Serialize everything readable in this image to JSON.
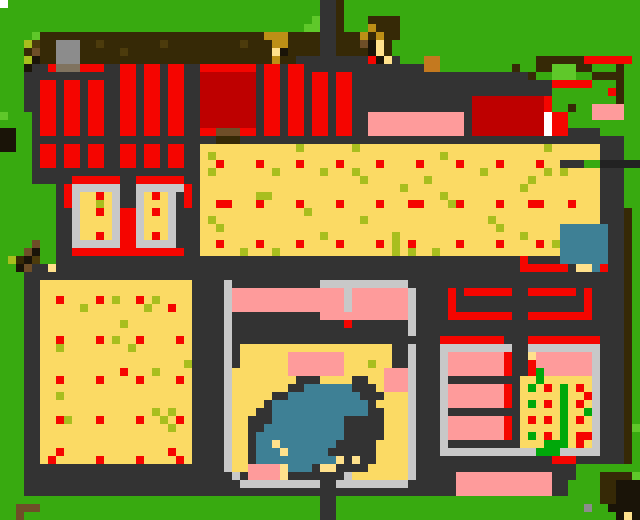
{
  "map": {
    "width_px": 640,
    "height_px": 520,
    "cell_size": 8,
    "cols": 80,
    "rows": 65,
    "palette": {
      "G": "#38AA10",
      "L": "#5FC82A",
      "N": "#00A80A",
      "D": "#333333",
      "C": "#C8C8C8",
      "E": "#8C8C8C",
      "m": "#80735F",
      "R": "#F50500",
      "r": "#BE0000",
      "P": "#FE9B9B",
      "Y": "#FBDA64",
      "F": "#FFE18C",
      "y": "#A8BE1E",
      "B": "#362906",
      "o": "#4C3B0C",
      "b": "#6E4E28",
      "O": "#C4791F",
      "U": "#BC8F16",
      "K": "#1A1408",
      "T": "#3E8095",
      "W": "#FFFFFF"
    },
    "legend": {
      "G": "grass",
      "L": "light-grass",
      "N": "crop-green",
      "D": "dark-path",
      "C": "light-stone",
      "E": "gray-block",
      "m": "stone-shadow",
      "R": "red-roof",
      "r": "dark-red-roof",
      "P": "pink-roof",
      "Y": "field-yellow",
      "F": "pale-sand",
      "y": "olive-sprout",
      "B": "dark-soil",
      "o": "soil-speck",
      "b": "wood-brown",
      "O": "orange-crate",
      "U": "gold",
      "K": "black-soil",
      "T": "pond-water",
      "W": "white"
    },
    "rows_rle": [
      "W1G39D2B1G37",
      "G40D2B1G37",
      "G39L1D2B1G3B4G30",
      "G38L2D2B1G3U1B3G30",
      "G4L1B28U3B4D2B3U1B1U1B2G30",
      "G3y1o1B2E3B2o1B7o1B9o1B3U2B4D2B3b1K1F1B1G31",
      "G3B1b1B2E3B5o1B18F1K1B4D2B4K1F1B1G31",
      "G3y1K1B2E3B24U1B2D9R1K1F1D1G3O2G12B6R6G1",
      "G3K1D2R1m3R3D2R2D1R2D1R2D2R7D1R2D1R2D15O2G9B1G2B2L3B2G3B1G2",
      "G3D12R2D1R2D1R2D2r7D1R2D1R2D1R2D1R2D22B1G2L3G2B4G2",
      "G3D2R2D1R2D1R2D2R2D1R2D1R2D2r7D1R2D1R2D1R2D1R2D25R5G3B1G2",
      "G3D2R2D1R2D1R2D2R2D1R2D1R2D2r7D1R2D1R2D1R2D1R2D25G7R1B1G2",
      "G3D2R2D1R2D1R2D2R2D1R2D1R2D2r7D1R2D1R2D1R2D1R2D15r9R1G8B1G2",
      "G3D2R2D1R2D1R2D2R2D1R2D1R2D2r7D1R2D1R2D1R2D1R2D15r9R1G2B1G2P4G2",
      "L1G3D1R2D1R2D1R2D2R2D1R2D1R2D2r7D1R2D1R2D1R2D1R2D2P12D1r9W1R2G3P4G2",
      "G4D1R2D1R2D1R2D2R2D1R2D1R2D2r7D1R2D1R2D1R2D1R2D2P12D1r9W1R2G9",
      "K2G2D1R2D1R2D1R2D2R2D1R2D1R2D2R2b3R2D1R2D1R2D1R2D1R2D2P12D1r9W1R2D4G5",
      "K2G2D23B3D48G2",
      "K2G2D1R2D1R2D1R2D2R2D1R2D1R2D2Y12y1Y6y1Y23y1Y6D3G2",
      "G4D1R2D1R2D1R2D2R2D1R2D1R2D2Y1y1Y28y1Y19D3G2",
      "G4D1R2D1R2D1R2D2R2D1R2D1R2D2Y2R1Y4R1Y4R1Y4R1Y4R1Y4R1Y4R1Y4R1Y4R1Y2D3G2",
      "G4D21Y1y1Y7y1Y5y1Y3y1Y15y1Y7y1Y1y1Y4D3G2",
      "G4D5R6D2R6D2Y20y1Y7y1Y12y1Y8D3G2",
      "G7D1R1C6D2C6R1D1Y25y1Y14y1Y9D3G2",
      "G7D1R1C1Y2R1Y1C1D2C1Y1R1Y1C1D1R1D1Y7y2Y21y1Y19D3G2",
      "G7D1R1C1Y2y1Y1C1D2C1Y3C1D1R1D1Y2R2Y3R1Y4R1Y4R1Y4R1Y3R2Y3y1R1Y4R1Y3R2Y3R1Y3D3G2",
      "G7D2C1Y2R1Y1C1R2C1Y1R1Y1C1D3Y13y1Y36D3B1G1",
      "G7D2C1Y4C1R2C1Y3C1D3Y1y1Y18y1Y15y1Y13D3B1G1",
      "G7D2C1Y4C1R2C1Y3C1D3Y2y1Y34y1Y7T6D2B1G1",
      "G7D2C1Y2R1Y1C1R2C1Y1R1Y1C1D3Y15y1Y8y1Y15y1Y4T6D2B1G1",
      "G4b1G2D2C6R2C5D3Y2R1Y4R1Y4R1Y4R1Y4R1Y1y1Y1R1Y5R1Y4R1Y4R1Y1y1T6D2B1G1",
      "G3b1K1G2D2R14D2Y5y1Y3y1Y14y1Y1y1Y2y1Y15T6D2B1G1",
      "G1y1B1K1o1G2D58R1D4T6D2B1G1",
      "G2K1b1D2F1D58R6D1F2T1R1D2B1G1",
      "G3D75B1G1",
      "G3D2Y19D4C1D11C11D27B1G1",
      "G3D2Y19D4C1P14C1P7C1D4R1D1R6D2R6D1R1D4B1G1",
      "G3D2Y2R1Y4R1Y1y1Y2R1Y1y1Y4D4C1P14C1P7C1D4R1D16R1D4B1G1",
      "G3D2Y5y1Y7y1Y2R1Y2D4C1P14C1P7C1D4R1D16R1D4B1G1",
      "G3D2Y19D4C1D11P11C1D4R8D2R8D4B1G1",
      "G3D2Y10y1Y8D4C1D14R1D7C1D26B1G1",
      "G3D2Y19D4C1D22C1D26B1G1",
      "G3D2Y2R1Y4R1Y1y1Y2R1Y4R1Y1D4C1D26R8D3R9D3B1G1",
      "G3D2Y2y1Y8y1Y7D4C1D1Y19D2C1D3C9D2C9D3B1G1",
      "G3D2Y19D4C1D1Y6P7Y6D2C1D3C1P7R1D2F1P7C1D3B1G1",
      "G3D2Y18y1D4C1D1Y6P7Y3y1Y2D2C1D3C1P7R1D2R1P7C1D3B1G1",
      "G3D2Y10R1Y3y1Y4D4C1Y7P7Y5P3C1D3C1P7R1D2R1N1P6C1D3B1G1",
      "G3D2Y2R1Y4R1Y4R1Y4R1Y1D4C1Y8D3Y4D2Y2P3C1D3C1D9Y2N1Y6C1D3B1G1",
      "G3D2Y19D4C1Y7D2T6D3Y1P3C1D3C1P7R1D1Y1N1Y1R1Y1N1Y1R1Y1C1D3B1G1",
      "G3D2Y2y1Y16D4C1Y5D2T9D3Y3C1D3C1P7R1D1Y5N1Y2R1C1D3B1G1",
      "G3D2Y19D4C1Y4D1T12D1Y4C1D3C1P7R1D1Y1N1Y1R1Y1N1Y1R1Y1C1D3B1G1",
      "G3D2Y14y1Y1y1Y2D4C1Y3D2T12D2Y3C1D3C1D9Y5N1Y2N1C1D3B1G1",
      "G3D2Y2R1y1Y3R1Y4R1Y2y1Y1R1Y1D4C1Y2D3T9D5Y3C1D3C1P7R1D1Y1R1Y1R1Y1N1Y1R1Y1C1D3B1G1",
      "G3D2Y16y1Y2D4C1Y2D2T10D5Y3C1D3C1P7R1D1Y5N1Y3C1D3B1L1",
      "G3D2Y19D4C1Y2D1T11D5Y3C1D3C1P7R1D1Y1N1Y1R1Y1N1Y1R2C1D3B1G1",
      "G3D2Y19D4C1Y2D1T2F1T7D5Y4C1D3C1D9Y3N3Y1R1Y1C1D3B1G1",
      "G3D2Y2R1Y13R1Y2D4C1Y2D1T3F1T5D6Y4C1D3C12N3C5D3B1G1",
      "G3D2Y1R1Y5R1Y4R1Y4R1Y1D4C1Y2D1T10F1D1F1D2Y4C1D17R3D6B1G1",
      "G3D25C1Y2P4F1T3D1F2D4Y5C1D20G8",
      "G3D26C1D1P4F1D7C1Y7C1D5P12D3G3B4L1",
      "G3D27C10D2C9D6P12D2G4B2K3",
      "G3D54P12D2G4B2K3",
      "G40D2G33B2K3",
      "G2b3G35D2G31E1G2K4",
      "G2b1G37D2G35K1F1K1"
    ]
  }
}
